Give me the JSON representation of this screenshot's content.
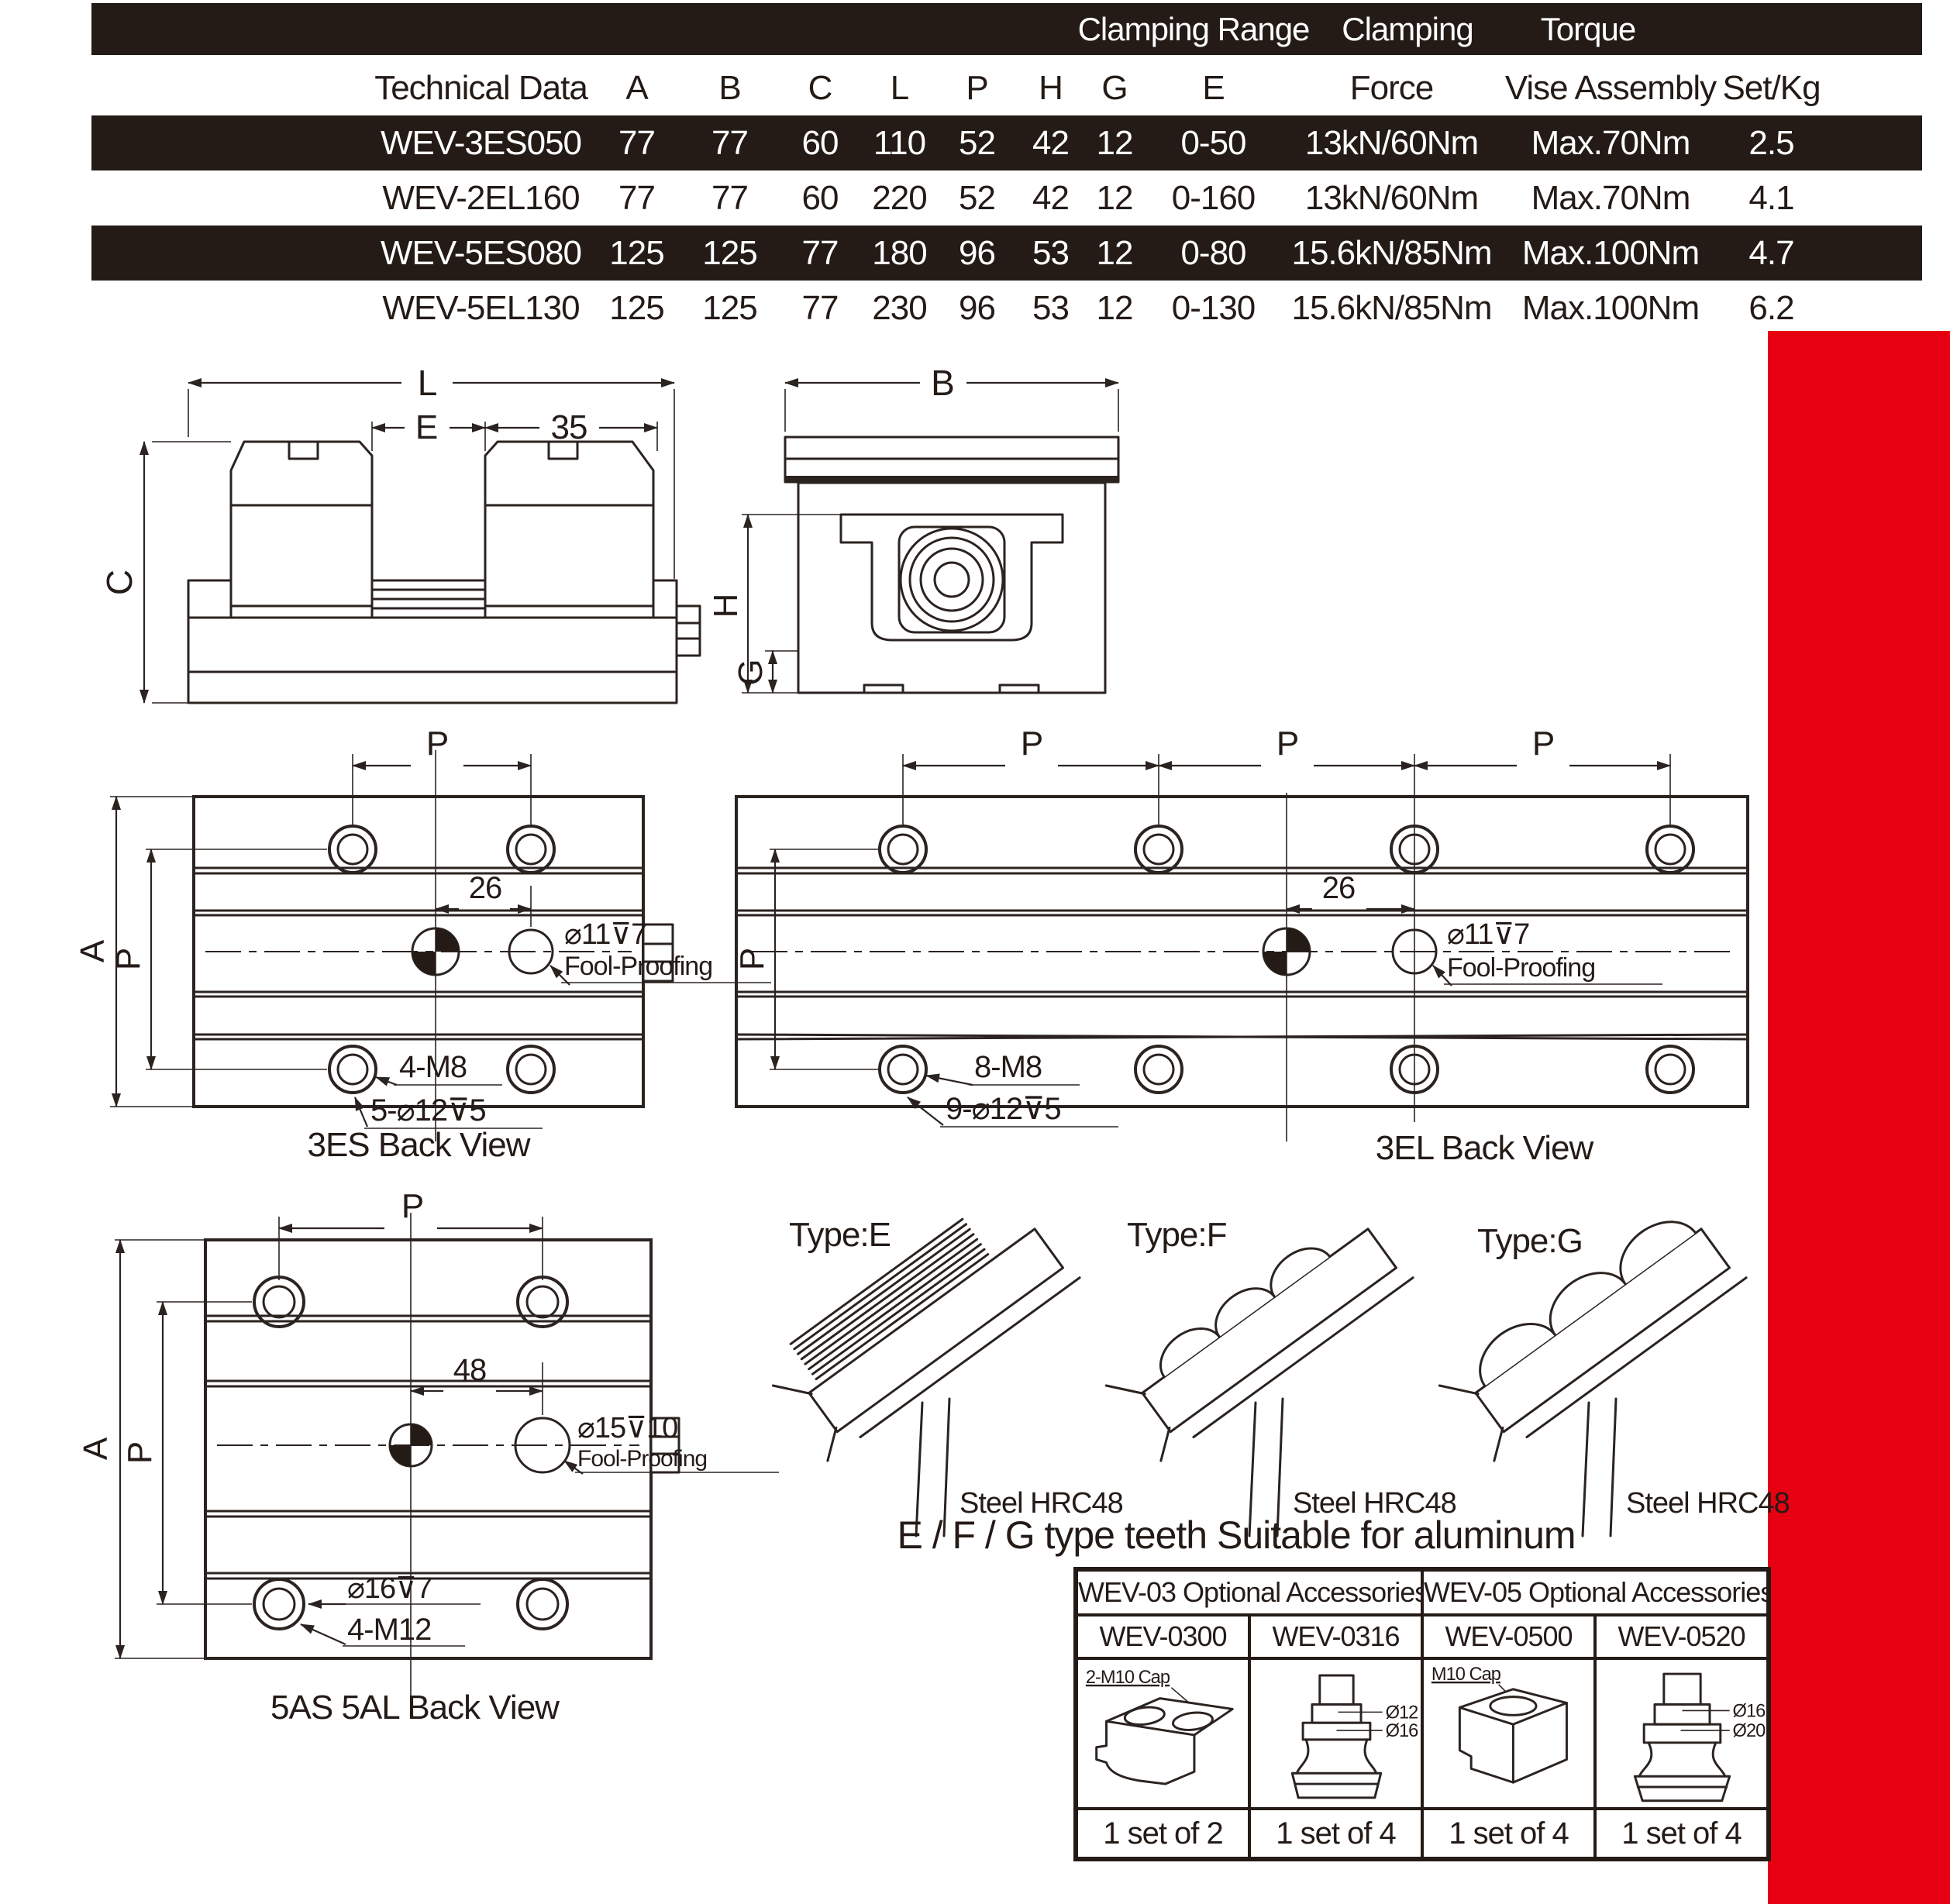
{
  "colors": {
    "accent_red": "#e60012",
    "band_dark": "#241b17",
    "line": "#2b2320"
  },
  "spec_table": {
    "group_headers": {
      "clamping_range": "Clamping Range",
      "clamping": "Clamping",
      "torque": "Torque"
    },
    "columns": [
      "Technical Data",
      "A",
      "B",
      "C",
      "L",
      "P",
      "H",
      "G",
      "E",
      "Force",
      "Vise Assembly",
      "Set/Kg"
    ],
    "rows": [
      [
        "WEV-3ES050",
        "77",
        "77",
        "60",
        "110",
        "52",
        "42",
        "12",
        "0-50",
        "13kN/60Nm",
        "Max.70Nm",
        "2.5"
      ],
      [
        "WEV-2EL160",
        "77",
        "77",
        "60",
        "220",
        "52",
        "42",
        "12",
        "0-160",
        "13kN/60Nm",
        "Max.70Nm",
        "4.1"
      ],
      [
        "WEV-5ES080",
        "125",
        "125",
        "77",
        "180",
        "96",
        "53",
        "12",
        "0-80",
        "15.6kN/85Nm",
        "Max.100Nm",
        "4.7"
      ],
      [
        "WEV-5EL130",
        "125",
        "125",
        "77",
        "230",
        "96",
        "53",
        "12",
        "0-130",
        "15.6kN/85Nm",
        "Max.100Nm",
        "6.2"
      ]
    ]
  },
  "front_view": {
    "dim_l": "L",
    "dim_e": "E",
    "dim_35": "35",
    "dim_c": "C"
  },
  "side_view": {
    "dim_b": "B",
    "dim_h": "H",
    "dim_g": "G"
  },
  "back_3es": {
    "dim_p_top": "P",
    "dim_a": "A",
    "dim_p_left": "P",
    "dim_26": "26",
    "hole": "⌀11⊽7",
    "fool": "Fool-Proofing",
    "thread": "4-M8",
    "cbore": "5-⌀12⊽5",
    "caption": "3ES Back View"
  },
  "back_3el": {
    "dim_p1": "P",
    "dim_p2": "P",
    "dim_p3": "P",
    "dim_p_left": "P",
    "dim_26": "26",
    "hole": "⌀11⊽7",
    "fool": "Fool-Proofing",
    "thread": "8-M8",
    "cbore": "9-⌀12⊽5",
    "caption": "3EL Back View"
  },
  "back_5as": {
    "dim_p_top": "P",
    "dim_a": "A",
    "dim_p_left": "P",
    "dim_48": "48",
    "hole": "⌀15⊽10",
    "fool": "Fool-Proofing",
    "cbore": "⌀16⊽7",
    "thread": "4-M12",
    "caption": "5AS 5AL Back View"
  },
  "teeth": {
    "type_e": "Type:E",
    "type_f": "Type:F",
    "type_g": "Type:G",
    "steel": "Steel HRC48",
    "caption": "E / F / G type teeth Suitable for aluminum"
  },
  "accessories": {
    "group_wev03": "WEV-03 Optional Accessories",
    "group_wev05": "WEV-05 Optional Accessories",
    "models": [
      "WEV-0300",
      "WEV-0316",
      "WEV-0500",
      "WEV-0520"
    ],
    "labels": {
      "cap_0300": "2-M10 Cap",
      "d12": "Ø12",
      "d16": "Ø16",
      "cap_0500": "M10 Cap",
      "d16b": "Ø16",
      "d20": "Ø20"
    },
    "qty": [
      "1 set of 2",
      "1 set of 4",
      "1 set of 4",
      "1 set of 4"
    ]
  }
}
